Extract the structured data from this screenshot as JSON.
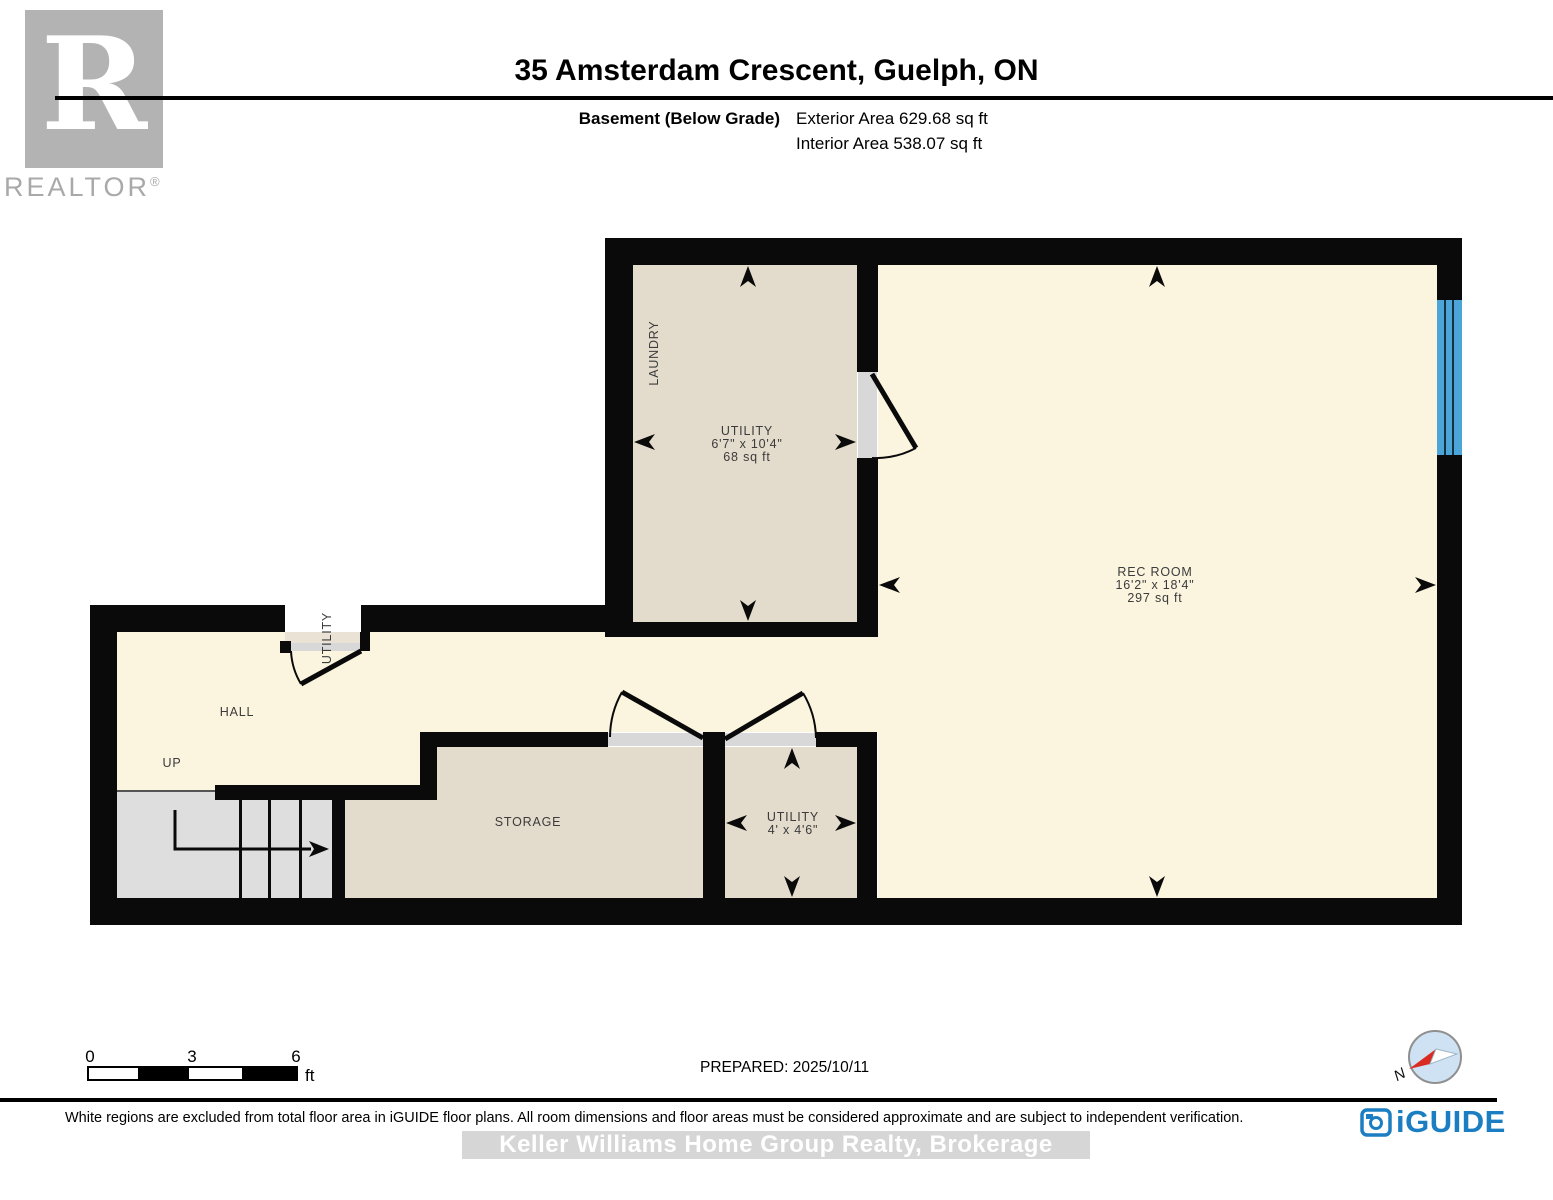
{
  "header": {
    "title": "35 Amsterdam Crescent, Guelph, ON",
    "floor_label": "Basement (Below Grade)",
    "exterior_area": "Exterior Area 629.68 sq ft",
    "interior_area": "Interior Area 538.07 sq ft"
  },
  "branding": {
    "realtor_logo_letter": "R",
    "realtor_logo_text": "REALTOR",
    "realtor_logo_reg": "®",
    "iguide_wordmark": "iGUIDE"
  },
  "plan": {
    "rooms": {
      "laundry": {
        "label": "LAUNDRY"
      },
      "utility_main": {
        "label": "UTILITY",
        "dimensions": "6'7\" x 10'4\"",
        "area": "68 sq ft"
      },
      "rec_room": {
        "label": "REC ROOM",
        "dimensions": "16'2\" x 18'4\"",
        "area": "297 sq ft"
      },
      "hall": {
        "label": "HALL"
      },
      "stairs": {
        "label": "UP"
      },
      "storage": {
        "label": "STORAGE"
      },
      "utility_small": {
        "label": "UTILITY",
        "dimensions": "4' x 4'6\""
      },
      "utility_closet": {
        "label": "UTILITY"
      }
    }
  },
  "scale_bar": {
    "tick_0": "0",
    "tick_3": "3",
    "tick_6": "6",
    "unit": "ft"
  },
  "compass": {
    "north_label": "N"
  },
  "footer": {
    "prepared": "PREPARED: 2025/10/11",
    "disclaimer": "White regions are excluded from total floor area in iGUIDE floor plans. All room dimensions and floor areas must be considered approximate and are subject to independent verification.",
    "watermark": "Keller Williams Home Group Realty,  Brokerage"
  },
  "colors": {
    "wall": "#0A0A0A",
    "included_floor": "#FBF5E0",
    "room_floor": "#E3DCCC",
    "stairs_floor": "#DEDEDE",
    "door_threshold": "#D8D8D8",
    "closet_floor": "#EAE3D5",
    "window": "#4BA5D9",
    "brand_blue": "#1B7EC3",
    "compass_red": "#D92B22",
    "logo_gray": "#B3B3B3",
    "watermark_bg": "#D6D6D6"
  }
}
